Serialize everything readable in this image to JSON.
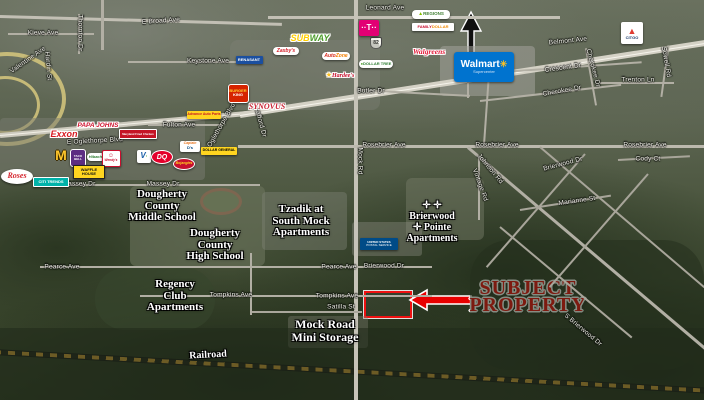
{
  "map_labels": {
    "route_shield": "82"
  },
  "subject_property": {
    "line1": "SUBJECT",
    "line2": "PROPERTY",
    "accent_color": "#e80000"
  },
  "streets": [
    {
      "t": "E Broad Ave",
      "x": 161,
      "y": 21,
      "r": -4
    },
    {
      "t": "Leonard Ave",
      "x": 385,
      "y": 8,
      "r": 0
    },
    {
      "t": "Kieve Ave",
      "x": 43,
      "y": 33,
      "r": 0
    },
    {
      "t": "Valentine Ave",
      "x": 28,
      "y": 60,
      "r": -35
    },
    {
      "t": "Thornton Dr",
      "x": 80,
      "y": 33,
      "r": 90
    },
    {
      "t": "Hardin St",
      "x": 48,
      "y": 66,
      "r": 85
    },
    {
      "t": "Keystone Ave",
      "x": 208,
      "y": 61,
      "r": 0
    },
    {
      "t": "Fulton Ave",
      "x": 179,
      "y": 125,
      "r": 0
    },
    {
      "t": "E Oglethorpe Blvd",
      "x": 95,
      "y": 141,
      "r": -3
    },
    {
      "t": "E Oglethorpe Blvd",
      "x": 220,
      "y": 128,
      "r": -60
    },
    {
      "t": "Stafford Dr",
      "x": 260,
      "y": 121,
      "r": 75
    },
    {
      "t": "Massey Dr",
      "x": 79,
      "y": 184,
      "r": 0
    },
    {
      "t": "Massey Dr",
      "x": 163,
      "y": 184,
      "r": 0
    },
    {
      "t": "Rosebrier Ave",
      "x": 384,
      "y": 145,
      "r": 0
    },
    {
      "t": "Rosebrier Ave",
      "x": 497,
      "y": 145,
      "r": 0
    },
    {
      "t": "Rosebrier Ave",
      "x": 645,
      "y": 145,
      "r": 0
    },
    {
      "t": "Butler Dr",
      "x": 371,
      "y": 91,
      "r": 0
    },
    {
      "t": "Belmont Ave",
      "x": 568,
      "y": 41,
      "r": -6
    },
    {
      "t": "Crescent Dr",
      "x": 563,
      "y": 68,
      "r": -8
    },
    {
      "t": "Cherokee Dr",
      "x": 562,
      "y": 91,
      "r": -10
    },
    {
      "t": "Cherokee Dr",
      "x": 593,
      "y": 68,
      "r": 75
    },
    {
      "t": "Trenton Ln",
      "x": 638,
      "y": 80,
      "r": 0
    },
    {
      "t": "Sowell Rd",
      "x": 666,
      "y": 62,
      "r": 80
    },
    {
      "t": "Cody Ct",
      "x": 648,
      "y": 159,
      "r": 0
    },
    {
      "t": "Brierwood Dr",
      "x": 563,
      "y": 164,
      "r": -15
    },
    {
      "t": "Marianne St",
      "x": 577,
      "y": 201,
      "r": -8
    },
    {
      "t": "Vintage Rd",
      "x": 480,
      "y": 185,
      "r": 70
    },
    {
      "t": "Johnson Rd",
      "x": 490,
      "y": 169,
      "r": 50
    },
    {
      "t": "Mock Rd",
      "x": 360,
      "y": 161,
      "r": 90
    },
    {
      "t": "Pearce Ave",
      "x": 62,
      "y": 267,
      "r": 0
    },
    {
      "t": "Pearce Ave",
      "x": 339,
      "y": 267,
      "r": 0
    },
    {
      "t": "Brierwood Dr",
      "x": 384,
      "y": 266,
      "r": 0
    },
    {
      "t": "Tompkins Ave",
      "x": 231,
      "y": 295,
      "r": 0
    },
    {
      "t": "Tompkins Ave",
      "x": 337,
      "y": 296,
      "r": 0
    },
    {
      "t": "Satilla St",
      "x": 341,
      "y": 307,
      "r": 0
    },
    {
      "t": "S Brierwood Dr",
      "x": 583,
      "y": 330,
      "r": 40
    }
  ],
  "places": [
    {
      "name": "dougherty-county-middle-school",
      "lines": [
        "Dougherty",
        "County",
        "Middle School"
      ],
      "x": 162,
      "y": 206,
      "r": 0
    },
    {
      "name": "dougherty-county-high-school",
      "lines": [
        "Dougherty",
        "County",
        "High School"
      ],
      "x": 215,
      "y": 245,
      "r": 0
    },
    {
      "name": "tzadik-at-south-mock-apartments",
      "lines": [
        "Tzadik at",
        "South Mock",
        "Apartments"
      ],
      "x": 301,
      "y": 221,
      "r": 0
    },
    {
      "name": "brierwood-pointe-apartments",
      "lines": [
        "✛ ✛",
        "Brierwood",
        "✛ Pointe",
        "Apartments"
      ],
      "x": 432,
      "y": 222,
      "r": 0,
      "fs": 10
    },
    {
      "name": "regency-club-apartments",
      "lines": [
        "Regency",
        "Club",
        "Apartments"
      ],
      "x": 175,
      "y": 296,
      "r": 0
    },
    {
      "name": "mock-road-mini-storage",
      "lines": [
        "Mock Road",
        "Mini Storage"
      ],
      "x": 325,
      "y": 331,
      "r": 0,
      "fs": 12
    },
    {
      "name": "railroad-label",
      "lines": [
        "Railroad"
      ],
      "x": 208,
      "y": 355,
      "r": -3,
      "fs": 10
    }
  ],
  "logos": [
    {
      "name": "advance-auto-parts",
      "x": 204,
      "y": 115,
      "w": 34,
      "h": 8,
      "bg": "#ffd520",
      "rad": 1,
      "lines": [
        [
          {
            "t": "Advance Auto Parts",
            "c": "#c41425",
            "fs": 3.5,
            "b": 1
          }
        ]
      ]
    },
    {
      "name": "burger-king",
      "x": 237,
      "y": 92,
      "w": 19,
      "h": 17,
      "bg": "#d62300",
      "rad": 3,
      "bd": "1px solid #fff",
      "lines": [
        [
          {
            "t": "BURGER",
            "c": "#ffd12e",
            "fs": 4,
            "b": 1
          }
        ],
        [
          {
            "t": "KING",
            "c": "#fff",
            "fs": 4,
            "b": 1
          }
        ]
      ]
    },
    {
      "name": "renasant-bank",
      "x": 249,
      "y": 60,
      "w": 27,
      "h": 8,
      "bg": "#1b4fa0",
      "rad": 1,
      "lines": [
        [
          {
            "t": "RENASANT",
            "c": "#fff",
            "fs": 4,
            "b": 1
          }
        ]
      ]
    },
    {
      "name": "subway",
      "x": 310,
      "y": 38,
      "w": 44,
      "h": 11,
      "bg": "none",
      "ns": 1,
      "lines": [
        [
          {
            "t": "SUB",
            "c": "#ffce00",
            "fs": 9,
            "b": 1,
            "i": 1,
            "o": 1
          },
          {
            "t": "WAY",
            "c": "#4e9d2d",
            "fs": 9,
            "b": 1,
            "i": 1,
            "o": 1
          }
        ]
      ]
    },
    {
      "name": "zaxbys",
      "x": 286,
      "y": 51,
      "w": 26,
      "h": 8,
      "bg": "#fff",
      "rad": 4,
      "lines": [
        [
          {
            "t": "Zaxby's",
            "c": "#d5232c",
            "fs": 5,
            "b": 1,
            "i": 1
          }
        ]
      ]
    },
    {
      "name": "t-mobile",
      "x": 369,
      "y": 28,
      "w": 20,
      "h": 16,
      "bg": "#e20074",
      "rad": 2,
      "lines": [
        [
          {
            "t": "··T··",
            "c": "#fff",
            "fs": 8,
            "b": 1
          }
        ]
      ]
    },
    {
      "name": "autozone",
      "x": 336,
      "y": 56,
      "w": 28,
      "h": 8,
      "bg": "#fff",
      "rad": 4,
      "lines": [
        [
          {
            "t": "Auto",
            "c": "#d52b1e",
            "fs": 5,
            "b": 1,
            "i": 1
          },
          {
            "t": "Zone",
            "c": "#f37f00",
            "fs": 5,
            "b": 1,
            "i": 1
          }
        ]
      ]
    },
    {
      "name": "dollar-tree",
      "x": 376,
      "y": 64,
      "w": 34,
      "h": 8,
      "bg": "#fff",
      "rad": 4,
      "lines": [
        [
          {
            "t": "● ",
            "c": "#55a630",
            "fs": 4
          },
          {
            "t": "DOLLAR TREE",
            "c": "#2e7d32",
            "fs": 4,
            "b": 1
          }
        ]
      ]
    },
    {
      "name": "hardees",
      "x": 340,
      "y": 75,
      "w": 30,
      "h": 9,
      "bg": "none",
      "ns": 1,
      "lines": [
        [
          {
            "t": "★",
            "c": "#ffc220",
            "fs": 7,
            "o": 1
          },
          {
            "t": "Hardee's",
            "c": "#c8102e",
            "fs": 6,
            "b": 1,
            "i": 1,
            "o": 1,
            "sf": 1
          }
        ]
      ]
    },
    {
      "name": "synovus",
      "x": 267,
      "y": 107,
      "w": 48,
      "h": 11,
      "bg": "none",
      "ns": 1,
      "lines": [
        [
          {
            "t": "SYNOVUS",
            "c": "#cc2233",
            "fs": 8,
            "b": 1,
            "i": 1,
            "o": 1,
            "sf": 1
          }
        ]
      ]
    },
    {
      "name": "regions-bank",
      "x": 431,
      "y": 14,
      "w": 38,
      "h": 9,
      "bg": "#fff",
      "rad": 4,
      "lines": [
        [
          {
            "t": "▲",
            "c": "#84bd00",
            "fs": 5
          },
          {
            "t": " REGIONS",
            "c": "#3f7e31",
            "fs": 4.5,
            "b": 1
          }
        ]
      ]
    },
    {
      "name": "family-dollar",
      "x": 433,
      "y": 27,
      "w": 42,
      "h": 8,
      "bg": "#fff",
      "rad": 1,
      "lines": [
        [
          {
            "t": "FAMILY ",
            "c": "#c8102e",
            "fs": 4,
            "b": 1
          },
          {
            "t": "DOLLAR",
            "c": "#f18a00",
            "fs": 4,
            "b": 1
          }
        ]
      ]
    },
    {
      "name": "walgreens",
      "x": 429,
      "y": 52,
      "w": 44,
      "h": 10,
      "bg": "none",
      "ns": 1,
      "lines": [
        [
          {
            "t": "Walgreens",
            "c": "#e31837",
            "fs": 7.5,
            "b": 1,
            "i": 1,
            "o": 1,
            "sf": 1
          }
        ]
      ]
    },
    {
      "name": "walmart",
      "x": 484,
      "y": 67,
      "w": 60,
      "h": 30,
      "bg": "#0073cf",
      "rad": 3,
      "lines": [
        [
          {
            "t": "Walmart",
            "c": "#fff",
            "fs": 10,
            "b": 1
          },
          {
            "t": "✳",
            "c": "#ffc220",
            "fs": 9,
            "b": 1
          }
        ],
        [
          {
            "t": "Supercenter",
            "c": "#cfe3f7",
            "fs": 4
          }
        ]
      ]
    },
    {
      "name": "citgo",
      "x": 632,
      "y": 33,
      "w": 22,
      "h": 22,
      "bg": "#fff",
      "rad": 2,
      "lines": [
        [
          {
            "t": "▲",
            "c": "#e03c31",
            "fs": 9
          }
        ],
        [
          {
            "t": "CITGO",
            "c": "#1b3a6b",
            "fs": 4,
            "b": 1
          }
        ]
      ]
    },
    {
      "name": "papa-johns",
      "x": 98,
      "y": 126,
      "w": 44,
      "h": 10,
      "bg": "none",
      "ns": 1,
      "lines": [
        [
          {
            "t": "PAPA JOHNS",
            "c": "#cf1430",
            "fs": 6.5,
            "b": 1,
            "i": 1,
            "o": 1
          }
        ]
      ]
    },
    {
      "name": "maryland-fried-chicken",
      "x": 137,
      "y": 133,
      "w": 36,
      "h": 8,
      "bg": "#c41425",
      "rad": 1,
      "bd": "1px solid #fff",
      "lines": [
        [
          {
            "t": "Maryland Fried Chicken",
            "c": "#fff",
            "fs": 2.8,
            "b": 1
          }
        ]
      ]
    },
    {
      "name": "exxon",
      "x": 64,
      "y": 134,
      "w": 34,
      "h": 12,
      "bg": "none",
      "ns": 1,
      "lines": [
        [
          {
            "t": "Exxon",
            "c": "#d71920",
            "fs": 9,
            "b": 1,
            "i": 1,
            "o": 1
          }
        ]
      ]
    },
    {
      "name": "mcdonalds",
      "x": 61,
      "y": 155,
      "w": 18,
      "h": 18,
      "bg": "none",
      "ns": 1,
      "lines": [
        [
          {
            "t": "M",
            "c": "#ffc72c",
            "fs": 14,
            "b": 1,
            "od": 1
          }
        ]
      ]
    },
    {
      "name": "taco-bell",
      "x": 77,
      "y": 157,
      "w": 14,
      "h": 16,
      "bg": "#5c2d82",
      "rad": 3,
      "bd": "1px solid #fff",
      "lines": [
        [
          {
            "t": "TACO",
            "c": "#fff",
            "fs": 3,
            "b": 1
          }
        ],
        [
          {
            "t": "BELL",
            "c": "#fff",
            "fs": 3,
            "b": 1
          }
        ]
      ]
    },
    {
      "name": "hibachi-express",
      "x": 96,
      "y": 157,
      "w": 18,
      "h": 8,
      "bg": "#fff",
      "rad": 4,
      "lines": [
        [
          {
            "t": "Hibachi",
            "c": "#2e7d32",
            "fs": 4,
            "b": 1,
            "i": 1
          }
        ]
      ]
    },
    {
      "name": "wendys",
      "x": 110,
      "y": 157,
      "w": 17,
      "h": 15,
      "bg": "#fff",
      "rad": 2,
      "bd": "1px solid #c8102e",
      "lines": [
        [
          {
            "t": "☺",
            "c": "#c8102e",
            "fs": 6
          }
        ],
        [
          {
            "t": "Wendy's",
            "c": "#c8102e",
            "fs": 3.2,
            "b": 1,
            "i": 1
          }
        ]
      ]
    },
    {
      "name": "v-bank",
      "x": 144,
      "y": 156,
      "w": 14,
      "h": 13,
      "bg": "#fff",
      "rad": 2,
      "lines": [
        [
          {
            "t": "V",
            "c": "#1b5fa8",
            "fs": 8,
            "b": 1,
            "i": 1
          },
          {
            "t": "·",
            "c": "#55a630",
            "fs": 6,
            "b": 1
          }
        ]
      ]
    },
    {
      "name": "dairy-queen",
      "x": 161,
      "y": 156,
      "w": 20,
      "h": 12,
      "bg": "#e4002b",
      "rad": "50%",
      "bd": "1px solid #fff",
      "lines": [
        [
          {
            "t": "DQ",
            "c": "#fff",
            "fs": 7,
            "b": 1,
            "i": 1
          }
        ]
      ]
    },
    {
      "name": "captain-ds",
      "x": 190,
      "y": 146,
      "w": 20,
      "h": 11,
      "bg": "#fff",
      "rad": 2,
      "lines": [
        [
          {
            "t": "Captain",
            "c": "#e87722",
            "fs": 3.5,
            "b": 1,
            "i": 1
          }
        ],
        [
          {
            "t": "D's",
            "c": "#00437b",
            "fs": 4,
            "b": 1
          }
        ]
      ]
    },
    {
      "name": "dollar-general",
      "x": 219,
      "y": 151,
      "w": 36,
      "h": 8,
      "bg": "#ffd520",
      "rad": 1,
      "lines": [
        [
          {
            "t": "DOLLAR GENERAL",
            "c": "#000",
            "fs": 3.5,
            "b": 1
          }
        ]
      ]
    },
    {
      "name": "bojangles",
      "x": 183,
      "y": 163,
      "w": 20,
      "h": 10,
      "bg": "#c8102e",
      "rad": "50%",
      "bd": "1px solid #fff",
      "lines": [
        [
          {
            "t": "Bojangles",
            "c": "#ffd520",
            "fs": 3.5,
            "b": 1,
            "i": 1
          }
        ]
      ]
    },
    {
      "name": "waffle-house",
      "x": 88,
      "y": 171,
      "w": 30,
      "h": 12,
      "bg": "#ffd520",
      "rad": 1,
      "bd": "1px solid #222",
      "lines": [
        [
          {
            "t": "WAFFLE",
            "c": "#111",
            "fs": 4,
            "b": 1
          }
        ],
        [
          {
            "t": "HOUSE",
            "c": "#111",
            "fs": 4,
            "b": 1
          }
        ]
      ]
    },
    {
      "name": "roses",
      "x": 17,
      "y": 176,
      "w": 32,
      "h": 15,
      "bg": "#fff",
      "rad": "50%",
      "lines": [
        [
          {
            "t": "Roses",
            "c": "#d5232c",
            "fs": 8,
            "b": 1,
            "i": 1,
            "sf": 1
          }
        ]
      ]
    },
    {
      "name": "citi-trends",
      "x": 50,
      "y": 181,
      "w": 34,
      "h": 8,
      "bg": "#00b2a9",
      "rad": 1,
      "bd": "1px solid #fff",
      "lines": [
        [
          {
            "t": "CITI TRENDS",
            "c": "#fff",
            "fs": 4,
            "b": 1
          }
        ]
      ]
    },
    {
      "name": "usps",
      "x": 379,
      "y": 244,
      "w": 38,
      "h": 12,
      "bg": "#004b87",
      "rad": 1,
      "lines": [
        [
          {
            "t": "UNITED STATES",
            "c": "#fff",
            "fs": 3,
            "b": 1
          }
        ],
        [
          {
            "t": "POSTAL SERVICE",
            "c": "#fff",
            "fs": 3
          }
        ]
      ]
    }
  ]
}
